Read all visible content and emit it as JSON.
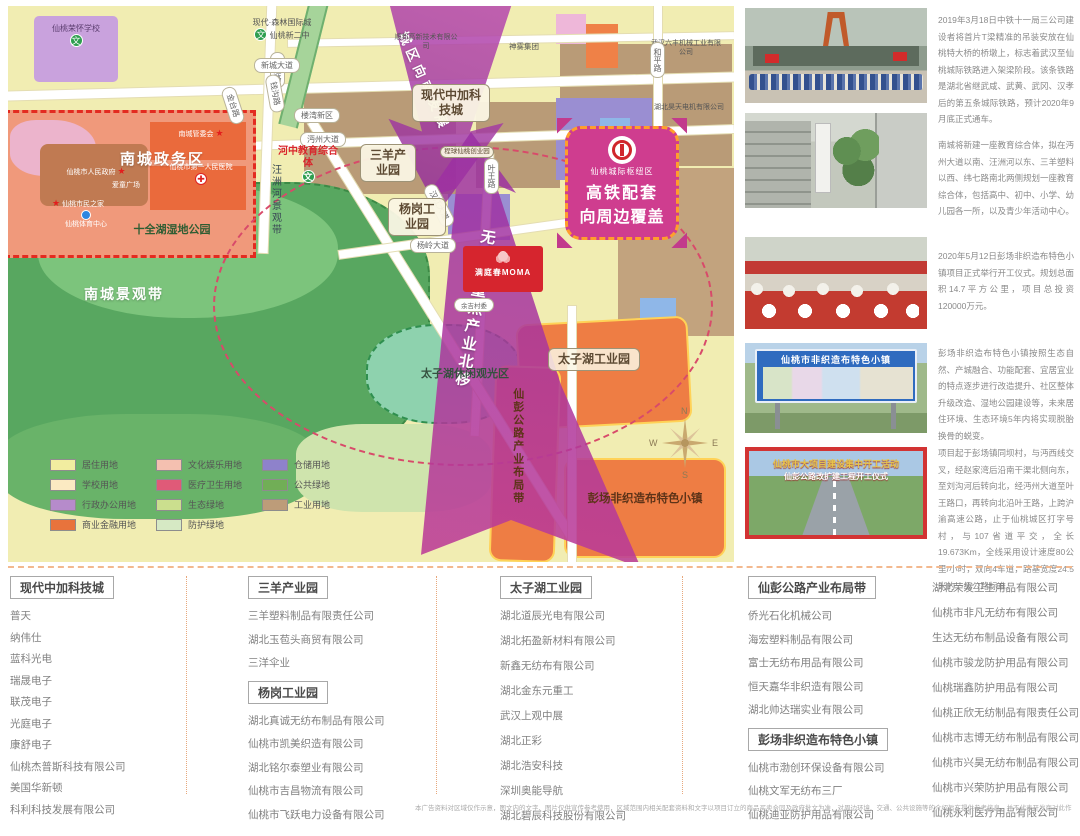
{
  "map": {
    "labels": {
      "ronghuai_school": "仙桃荣怀学校",
      "hangtong_rd": "杭通路",
      "jintai_rd": "金台路",
      "qiangou_rd": "钱沟路",
      "xincheng_ave": "新城大道",
      "modern_forest": "现代·森林国际城",
      "xintao_no2": "仙桃新二中",
      "nancheng_committee": "南城管委会",
      "first_hospital": "仙桃市第一人民医院",
      "aitong_plaza": "爱童广场",
      "city_gov": "仙桃市人民政府",
      "citizen_home": "仙桃市民之家",
      "sports_center": "仙桃体育中心",
      "nancheng_admin": "南城政务区",
      "shiquan_park": "十全湖湿地公园",
      "nancheng_belt": "南城景观带",
      "wangzhou_belt": "汪洲河景观带",
      "mianzhou_ave": "沔州大道",
      "hezhong_edu": "河中教育综合体",
      "louwan": "楼湾新区",
      "sanyang_park": "三羊产业园",
      "chengqiu_park": "程球仙桃创业园",
      "yewang_rd": "叶王路",
      "zhongjia_city": "现代中加科技城",
      "shunbang": "顺邦高新技术有限公司",
      "shenwu": "神雾集团",
      "liufeng": "武汉六丰机械工业有限公司",
      "heping_rd": "和平路",
      "haotian": "湖北昊天电机有限公司",
      "arrow_south": "城区向南发展",
      "hanjiang_ave": "汉江大道",
      "yanggang_park": "杨岗工业园",
      "yangling_ave": "杨岭大道",
      "moma": "满庭春MOMA",
      "yuji": "余吉村委",
      "taizihu_leisure": "太子湖休闲观光区",
      "taizihu_industrial": "太子湖工业园",
      "arrow_north": "无纺布重点产业北移",
      "xianpeng_belt": "仙彭公路产业布局带",
      "pengchang_town": "彭场非织造布特色小镇",
      "hub_tag": "仙桃城际枢纽区",
      "hub_line1": "高铁配套",
      "hub_line2": "向周边覆盖"
    },
    "icons": {
      "school": "文",
      "star": "★",
      "hospital": "✚"
    },
    "compass": {
      "n": "N",
      "e": "E",
      "s": "S",
      "w": "W"
    },
    "legend": {
      "col1": [
        {
          "label": "居住用地",
          "color": "#f2eda0"
        },
        {
          "label": "学校用地",
          "color": "#fbeac2"
        },
        {
          "label": "行政办公用地",
          "color": "#b68bcb"
        },
        {
          "label": "商业金融用地",
          "color": "#e8733c"
        }
      ],
      "col2": [
        {
          "label": "文化娱乐用地",
          "color": "#f4c0b0"
        },
        {
          "label": "医疗卫生用地",
          "color": "#e05a78"
        },
        {
          "label": "生态绿地",
          "color": "#cbdf8e"
        },
        {
          "label": "防护绿地",
          "color": "#d6e9c4"
        }
      ],
      "col3": [
        {
          "label": "仓储用地",
          "color": "#8e82cb"
        },
        {
          "label": "公共绿地",
          "color": "#71ae56"
        },
        {
          "label": "工业用地",
          "color": "#bd9c79"
        }
      ]
    }
  },
  "photos": [
    {
      "caption": "2019年3月18日中铁十一局三公司建设者将首片T梁精准的吊装安放在仙桃特大桥的桥墩上，标志着武汉至仙桃城际铁路进入架梁阶段。该条铁路是湖北省继武咸、武黄、武冈、汉孝后的第五条城际铁路，预计2020年9月底正式通车。"
    },
    {
      "caption": "南城将新建一座教育综合体，拟在沔州大道以南、汪洲河以东、三羊塑料以西、纬七路南北两侧规划一座教育综合体，包括高中、初中、小学、幼儿园各一所，以及青少年活动中心。"
    },
    {
      "caption": "2020年5月12日彭场非织造布特色小镇项目正式举行开工仪式。规划总面积14.7平方公里，项目总投资120000万元。"
    },
    {
      "caption": "彭场非织造布特色小镇按照生态自然、产城融合、功能配套、宜居宜业的特点逐步进行改造提升、社区整体升级改造、湿地公园建设等，未来居住环境、生态环境5年内将实现脱胎换骨的蜕变。",
      "billboard_title": "仙桃市非织造布特色小镇"
    },
    {
      "caption": "项目起于彭场镇同坝村，与沔西线交叉，经赵家湾后沿南干渠北侧向东，至刘沟河后转向北，经沔州大道至叶王路口，再转向北沿叶王路，上跨沪渝高速公路，止于仙桃城区打字号村，与107省道平交，全长19.673Km，全线采用设计速度80公里/小时，双向4车道，路基宽度24.5米的一级公路标准。",
      "banner_line1": "仙桃市大项目建设集中开工活动",
      "banner_line2": "仙彭公路改扩建工程开工仪式"
    }
  ],
  "bottom": {
    "col1": {
      "header": "现代中加科技城",
      "items": [
        "普天",
        "纳伟仕",
        "蓝科光电",
        "瑞晟电子",
        "联茂电子",
        "光庭电子",
        "康舒电子",
        "仙桃杰普斯科技有限公司",
        "美国华新顿",
        "科利科技发展有限公司"
      ]
    },
    "col2": {
      "header1": "三羊产业园",
      "items1": [
        "三羊塑料制品有限责任公司",
        "湖北玉苞头商贸有限公司",
        "三洋伞业"
      ],
      "header2": "杨岗工业园",
      "items2": [
        "湖北真诚无纺布制品有限公司",
        "仙桃市凯美织造有限公司",
        "湖北铭尔泰塑业有限公司",
        "仙桃市吉昌物流有限公司",
        "仙桃市飞跃电力设备有限公司"
      ]
    },
    "col3": {
      "header": "太子湖工业园",
      "items": [
        "湖北道辰光电有限公司",
        "湖北拓盈新材料有限公司",
        "新鑫无纺布有限公司",
        "湖北金东元重工",
        "武汉上观中展",
        "湖北正彩",
        "湖北浩安科技",
        "深圳奥能导航",
        "湖北碧辰科技股份有限公司"
      ]
    },
    "col4": {
      "header1": "仙彭公路产业布局带",
      "items1": [
        "侨光石化机械公司",
        "海宏塑料制品有限公司",
        "富士无纺布用品有限公司",
        "恒天嘉华非织造有限公司",
        "湖北帅达瑞实业有限公司"
      ],
      "header2": "彭场非织造布特色小镇",
      "items2": [
        "仙桃市渤创环保设备有限公司",
        "仙桃文军无纺布三厂",
        "仙桃迪亚防护用品有限公司"
      ]
    },
    "col5": {
      "items": [
        "湖北荣发卫生用品有限公司",
        "仙桃市非凡无纺布有限公司",
        "生达无纺布制品设备有限公司",
        "仙桃市骏龙防护用品有限公司",
        "仙桃瑞鑫防护用品有限公司",
        "仙桃正欣无纺制品有限责任公司",
        "仙桃市志博无纺布制品有限公司",
        "仙桃市兴昊无纺布制品有限公司",
        "仙桃市兴荣防护用品有限公司",
        "仙桃永利医疗用品有限公司"
      ]
    },
    "disclaimer": "本广告资料对区域仅作示意，图文内的文字、图片仅供宣传参考使用，区域范围内相关配套资料和文字以项目订立的商品买卖合同及政府批文为准，对周边环境、交通、公共设施等的介绍旨在提供参考信息，并不代表开发商对此作出承诺，本公司对宣传资料内所载图文的准确性保留最终解释权，购房请审慎核实相关资料。开发商：湖北宏泰仙桃城市发展有限公司。"
  }
}
